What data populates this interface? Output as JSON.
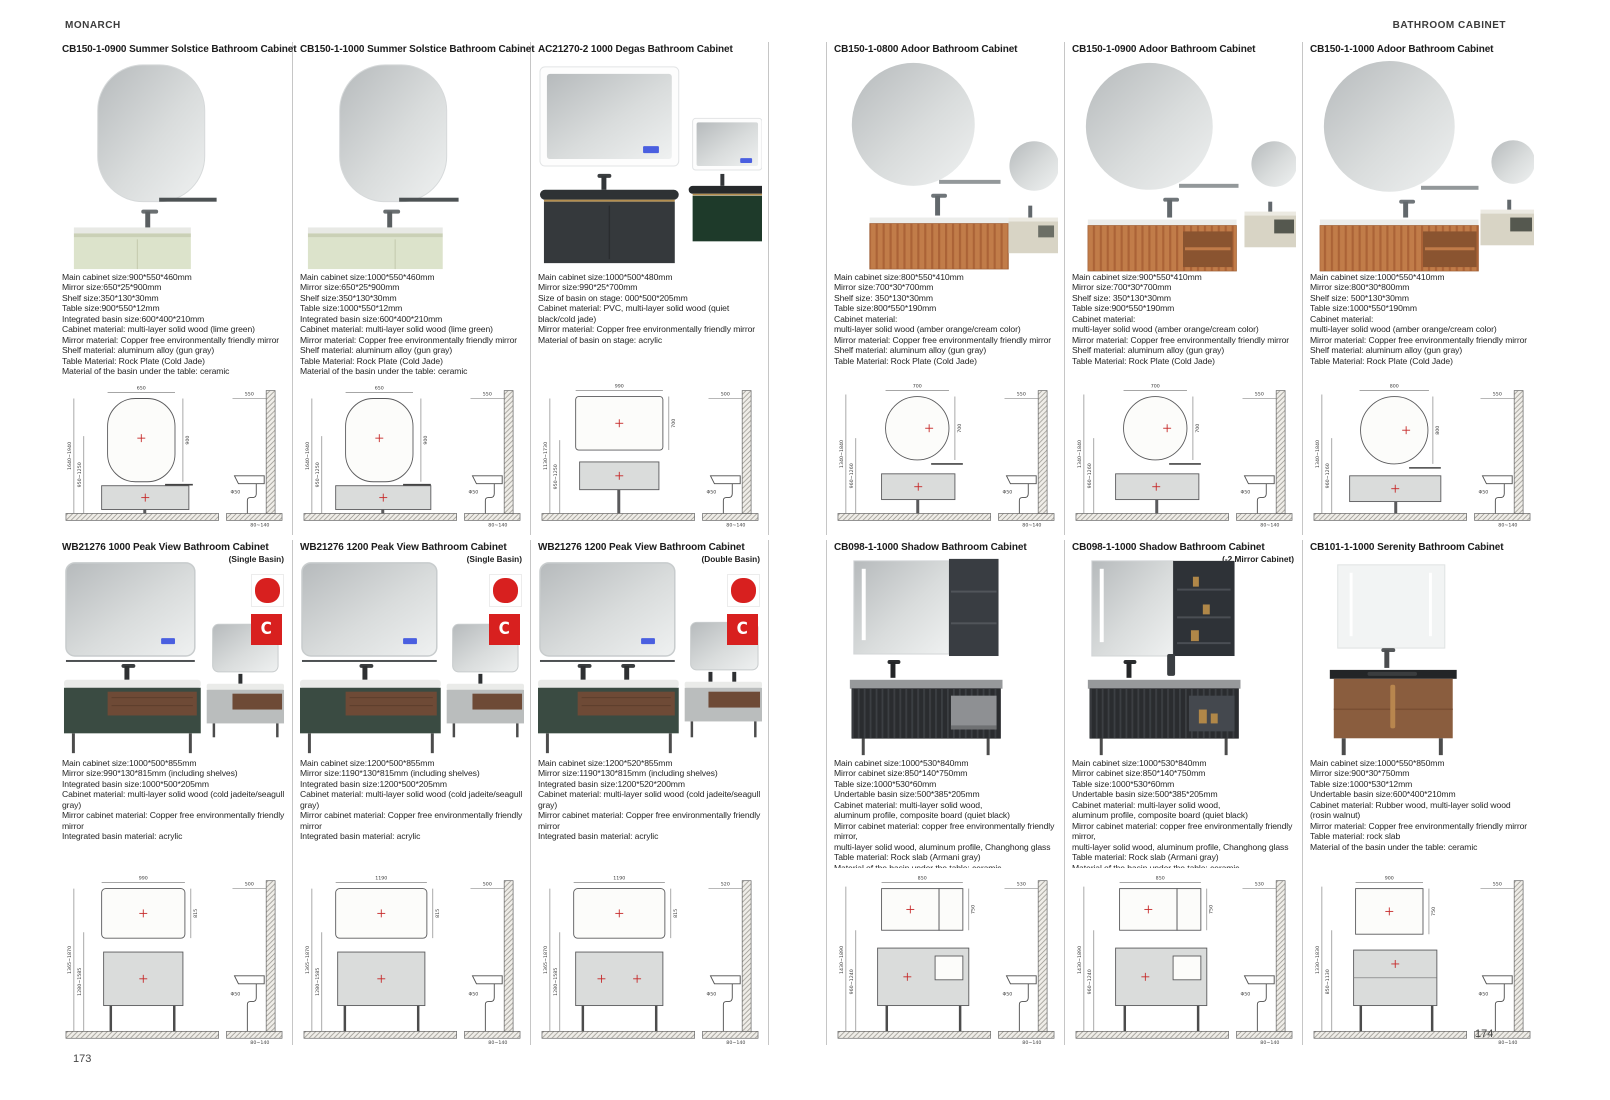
{
  "header": {
    "brand": "MONARCH",
    "category": "BATHROOM CABINET"
  },
  "footer": {
    "left_page": "173",
    "right_page": "174"
  },
  "colors": {
    "badge_red": "#d8201f",
    "lime_green": "#dce3cb",
    "amber_orange": "#c17c49",
    "cream": "#d8d4c5",
    "quiet_black": "#35393c",
    "cold_jade_green": "#1e3a2a",
    "peak_green": "#3a4b42",
    "seagull_gray": "#babdbd",
    "walnut": "#8a5d3e"
  },
  "products": [
    {
      "title": "CB150-1-0900 Summer Solstice Bathroom Cabinet",
      "specs": [
        "Main cabinet size:900*550*460mm",
        "Mirror size:650*25*900mm",
        "Shelf size:350*130*30mm",
        "Table size:900*550*12mm",
        "Integrated basin size:600*400*210mm",
        "Cabinet material: multi-layer solid wood (lime green)",
        "Mirror material: Copper free environmentally friendly mirror",
        "Shelf material: aluminum alloy (gun gray)",
        "Table Material: Rock Plate (Cold Jade)",
        "Material of the basin under the table: ceramic"
      ],
      "drawing": {
        "front_width": "650",
        "front_height": "900",
        "install_height": "1640~1940",
        "counter_height": "950~1250",
        "side_depth": "550",
        "drain": "Φ50",
        "floor_gap": "80~140"
      }
    },
    {
      "title": "CB150-1-1000 Summer Solstice Bathroom Cabinet",
      "specs": [
        "Main cabinet size:1000*550*460mm",
        "Mirror size:650*25*900mm",
        "Shelf size:350*130*30mm",
        "Table size:1000*550*12mm",
        "Integrated basin size:600*400*210mm",
        "Cabinet material: multi-layer solid wood (lime green)",
        "Mirror material: Copper free environmentally friendly mirror",
        "Shelf material: aluminum alloy (gun gray)",
        "Table Material: Rock Plate (Cold Jade)",
        "Material of the basin under the table: ceramic"
      ],
      "drawing": {
        "front_width": "650",
        "front_height": "900",
        "install_height": "1640~1940",
        "counter_height": "950~1250",
        "side_depth": "550",
        "drain": "Φ50",
        "floor_gap": "80~140"
      }
    },
    {
      "title": "AC21270-2 1000 Degas Bathroom Cabinet",
      "specs": [
        "Main cabinet size:1000*500*480mm",
        "Mirror size:990*25*700mm",
        "Size of basin on stage: 000*500*205mm",
        "Cabinet material: PVC, multi-layer solid wood (quiet black/cold jade)",
        "Mirror material: Copper free environmentally friendly mirror",
        "Material of basin on stage: acrylic"
      ],
      "drawing": {
        "front_width": "990",
        "front_height": "700",
        "install_height": "1130~1730",
        "counter_height": "950~1250",
        "side_depth": "500",
        "drain": "Φ50",
        "floor_gap": "80~140"
      }
    },
    {
      "title": "CB150-1-0800 Adoor Bathroom Cabinet",
      "specs": [
        "Main cabinet size:800*550*410mm",
        "Mirror size:700*30*700mm",
        "Shelf size: 350*130*30mm",
        "Table size:800*550*190mm",
        "Cabinet material:",
        "multi-layer solid wood (amber orange/cream color)",
        "Mirror material: Copper free environmentally friendly mirror",
        "Shelf material: aluminum alloy (gun gray)",
        "Table Material: Rock Plate (Cold Jade)"
      ],
      "drawing": {
        "front_width": "700",
        "front_height": "700",
        "install_height": "1340~1840",
        "counter_height": "960~1260",
        "side_depth": "550",
        "drain": "Φ50",
        "floor_gap": "80~140"
      }
    },
    {
      "title": "CB150-1-0900 Adoor Bathroom Cabinet",
      "specs": [
        "Main cabinet size:900*550*410mm",
        "Mirror size:700*30*700mm",
        "Shelf size: 350*130*30mm",
        "Table size:900*550*190mm",
        "Cabinet material:",
        "multi-layer solid wood (amber orange/cream color)",
        "Mirror material: Copper free environmentally friendly mirror",
        "Shelf material: aluminum alloy (gun gray)",
        "Table Material: Rock Plate (Cold Jade)"
      ],
      "drawing": {
        "front_width": "700",
        "front_height": "700",
        "install_height": "1340~1840",
        "counter_height": "960~1260",
        "side_depth": "550",
        "drain": "Φ50",
        "floor_gap": "80~140"
      }
    },
    {
      "title": "CB150-1-1000 Adoor Bathroom Cabinet",
      "specs": [
        "Main cabinet size:1000*550*410mm",
        "Mirror size:800*30*800mm",
        "Shelf size: 500*130*30mm",
        "Table size:1000*550*190mm",
        "Cabinet material:",
        "multi-layer solid wood (amber orange/cream color)",
        "Mirror material: Copper free environmentally friendly mirror",
        "Shelf material: aluminum alloy (gun gray)",
        "Table Material: Rock Plate (Cold Jade)"
      ],
      "drawing": {
        "front_width": "800",
        "front_height": "800",
        "install_height": "1340~1840",
        "counter_height": "960~1260",
        "side_depth": "550",
        "drain": "Φ50",
        "floor_gap": "80~140"
      }
    },
    {
      "title": "WB21276 1000 Peak View Bathroom Cabinet",
      "subtitle": "(Single Basin)",
      "specs": [
        "Main cabinet size:1000*500*855mm",
        "Mirror size:990*130*815mm (including shelves)",
        "Integrated basin size:1000*500*205mm",
        "Cabinet material: multi-layer solid wood (cold jadeite/seagull gray)",
        "Mirror cabinet material: Copper free environmentally friendly mirror",
        "Integrated basin material: acrylic"
      ],
      "drawing": {
        "front_width": "990",
        "front_height": "815",
        "install_height": "1365~1870",
        "counter_height": "1280~1585",
        "side_depth": "500",
        "drain": "Φ50",
        "floor_gap": "80~140"
      }
    },
    {
      "title": "WB21276 1200 Peak View Bathroom Cabinet",
      "subtitle": "(Single Basin)",
      "specs": [
        "Main cabinet size:1200*500*855mm",
        "Mirror size:1190*130*815mm (including shelves)",
        "Integrated basin size:1200*500*205mm",
        "Cabinet material: multi-layer solid wood (cold jadeite/seagull gray)",
        "Mirror cabinet material: Copper free environmentally friendly mirror",
        "Integrated basin material: acrylic"
      ],
      "drawing": {
        "front_width": "1190",
        "front_height": "815",
        "install_height": "1365~1870",
        "counter_height": "1280~1585",
        "side_depth": "500",
        "drain": "Φ50",
        "floor_gap": "80~140"
      }
    },
    {
      "title": "WB21276 1200 Peak View Bathroom Cabinet",
      "subtitle": "(Double Basin)",
      "specs": [
        "Main cabinet size:1200*520*855mm",
        "Mirror size:1190*130*815mm (including shelves)",
        "Integrated basin size:1200*520*200mm",
        "Cabinet material: multi-layer solid wood (cold jadeite/seagull gray)",
        "Mirror cabinet material: Copper free environmentally friendly mirror",
        "Integrated basin material: acrylic"
      ],
      "drawing": {
        "front_width": "1190",
        "front_height": "815",
        "install_height": "1365~1870",
        "counter_height": "1280~1585",
        "side_depth": "520",
        "drain": "Φ50",
        "floor_gap": "80~140"
      }
    },
    {
      "title": "CB098-1-1000 Shadow Bathroom Cabinet",
      "specs": [
        "Main cabinet size:1000*530*840mm",
        "Mirror cabinet size:850*140*750mm",
        "Table size:1000*530*60mm",
        "Undertable basin size:500*385*205mm",
        "Cabinet material: multi-layer solid wood,",
        "aluminum profile, composite board (quiet black)",
        "Mirror cabinet material: copper free environmentally friendly mirror,",
        "multi-layer solid wood, aluminum profile, Changhong glass",
        "Table material: Rock slab (Armani gray)",
        "Material of the basin under the table: ceramic"
      ],
      "drawing": {
        "front_width": "850",
        "front_height": "750",
        "install_height": "1430~1890",
        "counter_height": "960~1240",
        "side_depth": "530",
        "drain": "Φ50",
        "floor_gap": "80~140"
      }
    },
    {
      "title": "CB098-1-1000 Shadow Bathroom Cabinet",
      "subtitle": "(-2 Mirror Cabinet)",
      "specs": [
        "Main cabinet size:1000*530*840mm",
        "Mirror cabinet size:850*140*750mm",
        "Table size:1000*530*60mm",
        "Undertable basin size:500*385*205mm",
        "Cabinet material: multi-layer solid wood,",
        "aluminum profile, composite board (quiet black)",
        "Mirror cabinet material: copper free environmentally friendly mirror,",
        "multi-layer solid wood, aluminum profile, Changhong glass",
        "Table material: Rock slab (Armani gray)",
        "Material of the basin under the table: ceramic"
      ],
      "drawing": {
        "front_width": "850",
        "front_height": "750",
        "install_height": "1430~1890",
        "counter_height": "960~1240",
        "side_depth": "530",
        "drain": "Φ50",
        "floor_gap": "80~140"
      }
    },
    {
      "title": "CB101-1-1000 Serenity Bathroom Cabinet",
      "specs": [
        "Main cabinet size:1000*550*850mm",
        "Mirror size:900*30*750mm",
        "Table size:1000*530*12mm",
        "Undertable basin size:600*400*210mm",
        "Cabinet material: Rubber wood, multi-layer solid wood (rosin walnut)",
        "Mirror material: Copper free environmentally friendly mirror",
        "Table material: rock slab",
        "Material of the basin under the table: ceramic"
      ],
      "drawing": {
        "front_width": "900",
        "front_height": "750",
        "install_height": "1330~1830",
        "counter_height": "850~1130",
        "side_depth": "550",
        "drain": "Φ50",
        "floor_gap": "80~140"
      }
    }
  ]
}
